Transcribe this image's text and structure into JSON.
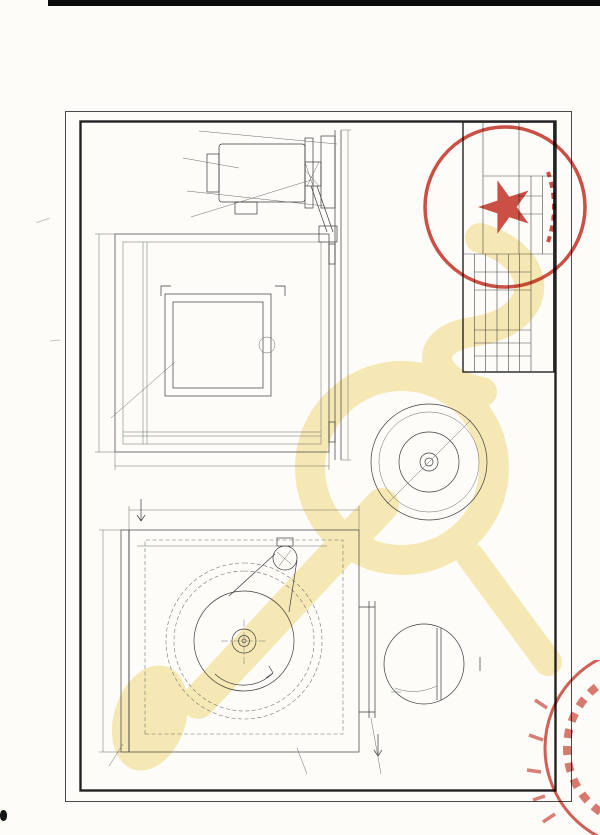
{
  "page_header": {
    "report_no": "No.FG020873-2020",
    "org_title": "国家消防及阻燃产品质量监督检验中心（山东）",
    "form_title": "检验报告附图附照专用表",
    "page_count": "共2页 第2页"
  },
  "drawing": {
    "dims": {
      "front_width": "1900",
      "front_height": "1850",
      "overall_length": "3000",
      "side_width": "1755",
      "side_height": "1780",
      "inlet_opening": "1734(W)×1680(H)",
      "outlet_opening": "1098(W)×996(H)",
      "impeller_diameter": "Ø950",
      "inlet_flange": "40",
      "outlet_flange": "90",
      "blade_detail": "10"
    },
    "labels": {
      "inlet": "进风口",
      "outlet": "出风口",
      "rotation": "旋转方向",
      "section_mark": "A",
      "section_view": "A—A",
      "detail_view": "B",
      "p1": "1",
      "p2": "2",
      "p3": "3",
      "p4": "4",
      "p5": "5",
      "p6": "6",
      "p7": "7",
      "p8": "8"
    }
  },
  "parts_table": {
    "headers": {
      "no": "序号",
      "name": "名  称",
      "spec": "型号规格",
      "qty": "数量",
      "supplier": "关键件及原材料供应商"
    },
    "rows": [
      {
        "no": "8",
        "name": "底座",
        "spec": "槽钢",
        "qty": "1",
        "supplier": ""
      },
      {
        "no": "7",
        "name": "电动机",
        "spec": "YE2-225M-4",
        "qty": "1",
        "supplier": "上海力标电机有限公司"
      },
      {
        "no": "6",
        "name": "皮带",
        "spec": "B型",
        "qty": "3",
        "supplier": ""
      },
      {
        "no": "5",
        "name": "皮带轮",
        "spec": "B型",
        "qty": "2",
        "supplier": ""
      },
      {
        "no": "4",
        "name": "叶片",
        "spec": "1.2mm镀锌板",
        "qty": "48×2",
        "supplier": ""
      },
      {
        "no": "3",
        "name": "进风口法兰",
        "spec": "1.5mm镀锌板",
        "qty": "1",
        "supplier": ""
      },
      {
        "no": "2",
        "name": "壳体 内板",
        "spec": "0.5mm镀锌板",
        "qty": "1",
        "supplier": ""
      },
      {
        "no": "",
        "name": "壳体 外板",
        "spec": "0.5mm彩钢板",
        "qty": "1",
        "supplier": ""
      },
      {
        "no": "1",
        "name": "出风口法兰",
        "spec": "1.5mm镀锌板",
        "qty": "1",
        "supplier": ""
      }
    ]
  },
  "title_block": {
    "company": "江苏通风设备有限公司",
    "product_name": "离心式消防排烟风机",
    "drawing_type": "总装图",
    "model": "HTFC-I-40",
    "stage_label": "阶段标记",
    "mass_label": "质量",
    "scale_label": "比例",
    "scale_value": "1:10",
    "sheet_note": "共 页 第 页",
    "rev_row": [
      "标记",
      "处数",
      "分区",
      "更改文件号",
      "签字",
      "日期"
    ],
    "sign_rows": {
      "design": "设计",
      "standard": "标准化",
      "check": "审核",
      "process": "工艺",
      "approve": "批准"
    }
  },
  "notes": {
    "lines": [
      "1.风机耐高温性能应符合GA211-2009《消防排烟风机耐",
      "2.输送介质温度：280℃,风机连续运转时间：30min;",
      "3.风机流量：92000m³/h, 风机全压：850Pa, 风机效率",
      "电机型号：YE2-225M-4, 电机功率：45kW, 电机转速",
      "风机转速：550r/min, 电机绝缘等级F级, 电机冷却方",
      "电机与叶轮联接方式：皮带联接, 叶片与叶轮的连接",
      "4.振动速度≤6.0mm/s."
    ]
  },
  "seal": {
    "ring_text": "江苏通风设备有限公司"
  },
  "colors": {
    "seal_red": "#c5392d",
    "watermark": "#f2db80",
    "line_dark": "#3c3c3c"
  }
}
